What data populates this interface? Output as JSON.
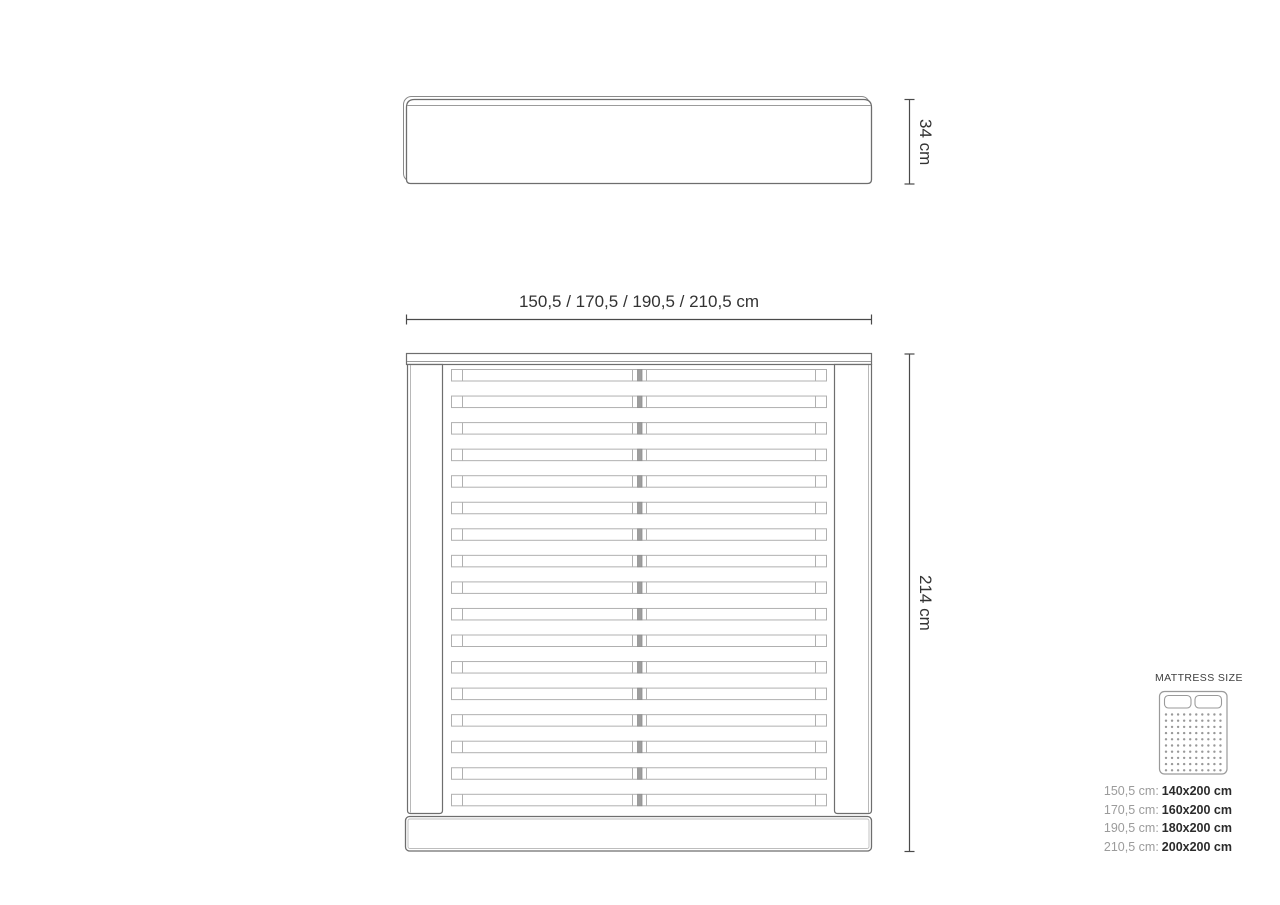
{
  "diagram": {
    "width_dimension": "150,5 / 170,5 / 190,5 / 210,5 cm",
    "headboard_height": "34 cm",
    "frame_length": "214 cm",
    "slat_count": 17
  },
  "mattress": {
    "title": "MATTRESS SIZE",
    "icon": "mattress-top-view-icon",
    "sizes": [
      {
        "frame": "150,5 cm:",
        "mattress": "140x200 cm"
      },
      {
        "frame": "170,5 cm:",
        "mattress": "160x200 cm"
      },
      {
        "frame": "190,5 cm:",
        "mattress": "180x200 cm"
      },
      {
        "frame": "210,5 cm:",
        "mattress": "200x200 cm"
      }
    ]
  },
  "colors": {
    "outline_dark": "#6e6e6e",
    "outline_light": "#b0b0b0",
    "seam_gray": "#9b9b9b",
    "center_bar_fill": "#9e9e9e",
    "dimension_line": "#4a4a4a",
    "dimension_text": "#333333",
    "label_gray": "#9b9b9b",
    "value_dark": "#2b2b2b",
    "icon_stroke": "#9a9a9a",
    "dot_gray": "#999999"
  }
}
